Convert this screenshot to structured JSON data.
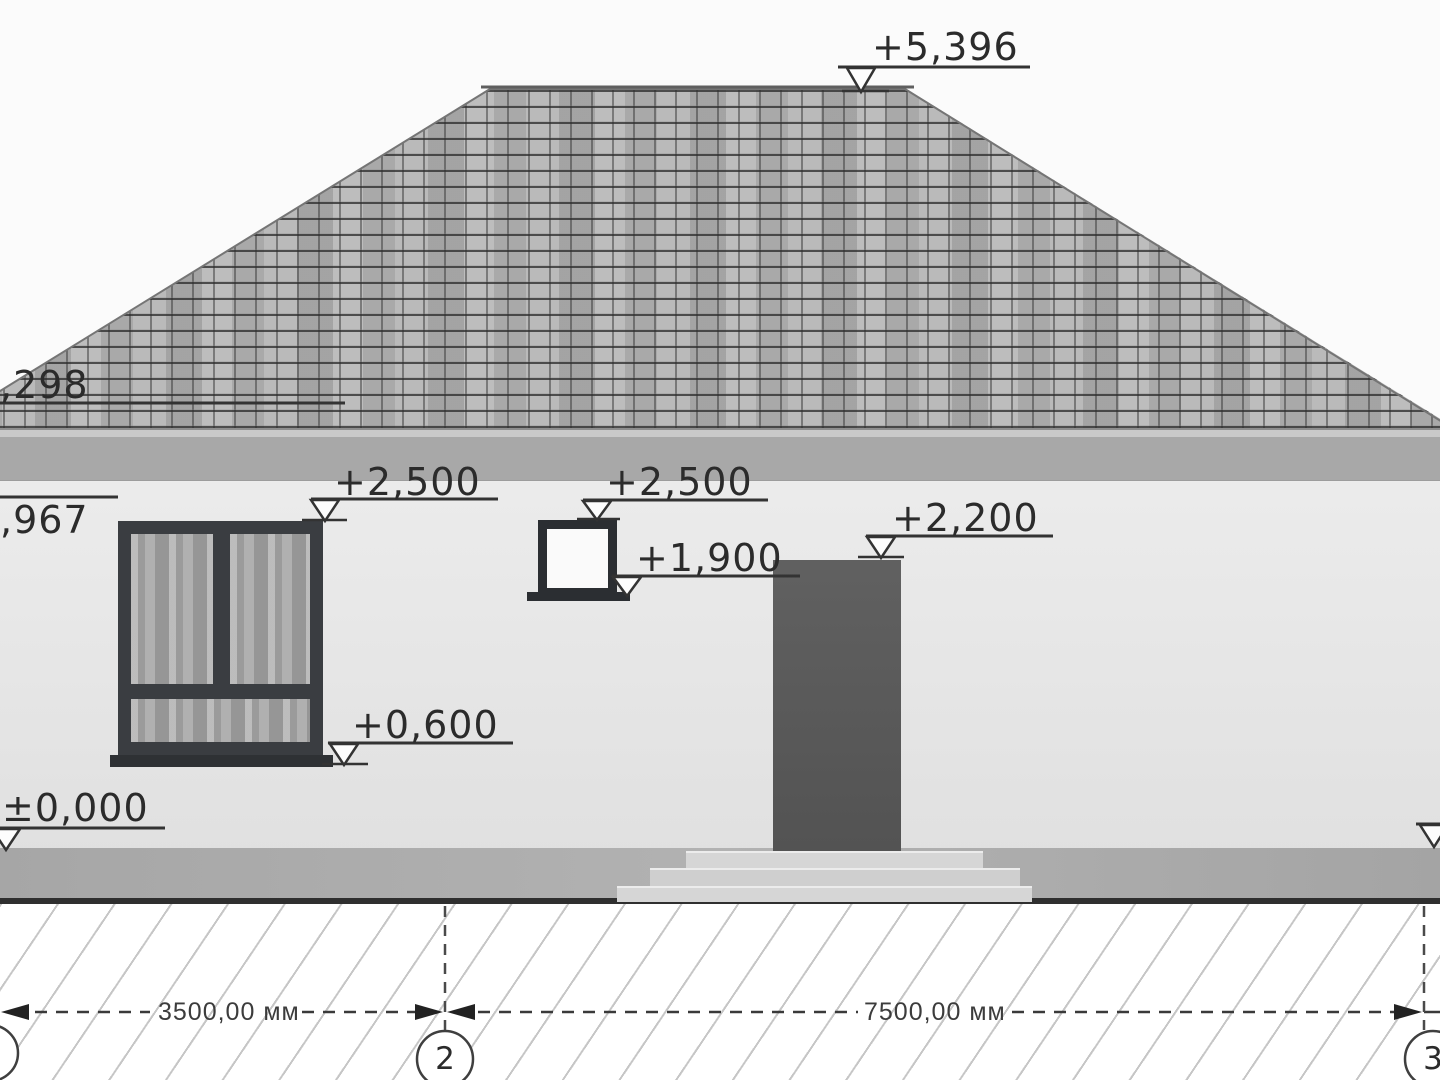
{
  "elevation_marks": {
    "roof_peak": "+5,396",
    "roof_eave_left_partial": ",298",
    "wall_top_left_partial": ",967",
    "window_left_top": "+2,500",
    "window_small_top": "+2,500",
    "window_small_bottom": "+1,900",
    "door_top": "+2,200",
    "window_left_bottom": "+0,600",
    "ground_zero": "±0,000"
  },
  "dimensions": {
    "span_left": "3500,00 мм",
    "span_right": "7500,00 мм"
  },
  "grid_axes": {
    "axis_2": "2",
    "axis_3": "3"
  },
  "colors": {
    "roof_tile": "#b6b6b6",
    "roof_grout": "#4a4a4a",
    "eave_band": "#a8a8a8",
    "wall": "#e5e5e5",
    "plinth": "#adadad",
    "window_frame": "#3a3d41",
    "glass": "#a3a3a3",
    "door": "#585858",
    "annotation_line": "#333333"
  }
}
